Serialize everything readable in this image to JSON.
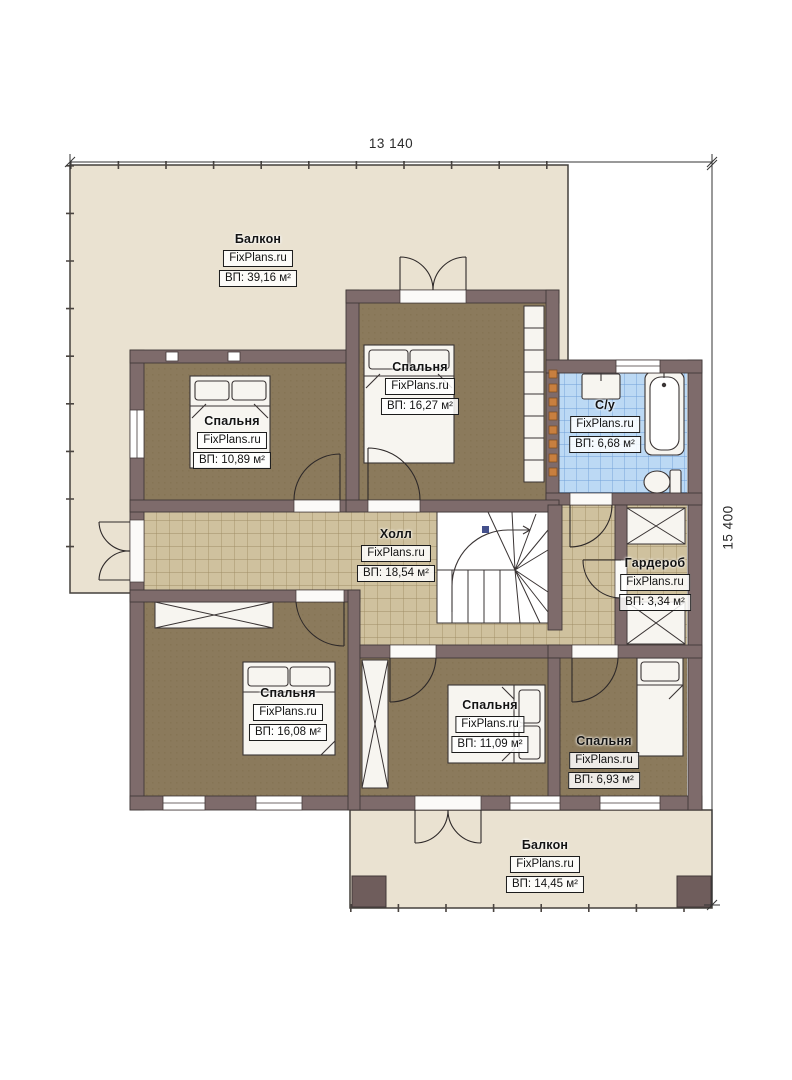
{
  "plan": {
    "brand": "FixPlans.ru",
    "dimensions": {
      "top": "13 140",
      "right": "15 400"
    },
    "rooms": [
      {
        "id": "balcony-top",
        "name": "Балкон",
        "area": "ВП: 39,16 м²"
      },
      {
        "id": "bedroom-top-left",
        "name": "Спальня",
        "area": "ВП: 10,89 м²"
      },
      {
        "id": "bedroom-top-middle",
        "name": "Спальня",
        "area": "ВП: 16,27 м²"
      },
      {
        "id": "bathroom",
        "name": "С/у",
        "area": "ВП: 6,68 м²"
      },
      {
        "id": "hall",
        "name": "Холл",
        "area": "ВП: 18,54 м²"
      },
      {
        "id": "wardrobe",
        "name": "Гардероб",
        "area": "ВП: 3,34 м²"
      },
      {
        "id": "bedroom-bottom-left",
        "name": "Спальня",
        "area": "ВП: 16,08 м²"
      },
      {
        "id": "bedroom-bottom-middle",
        "name": "Спальня",
        "area": "ВП: 11,09 м²"
      },
      {
        "id": "bedroom-bottom-right",
        "name": "Спальня",
        "area": "ВП: 6,93 м²"
      },
      {
        "id": "balcony-bottom",
        "name": "Балкон",
        "area": "ВП: 14,45 м²"
      }
    ],
    "colors": {
      "wall": "#7e6b6b",
      "bedroom_floor": "#8b7a5c",
      "tile_floor": "#cfc19e",
      "bathroom_tile": "#bcd9f4",
      "balcony": "#eae2d1"
    }
  }
}
